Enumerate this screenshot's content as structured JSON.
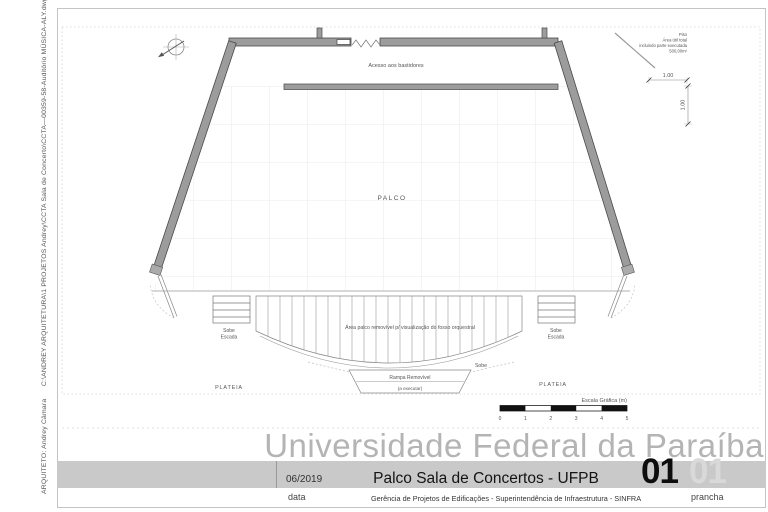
{
  "colors": {
    "wall_fill": "#9c9c9c",
    "wall_stroke": "#4a4a4a",
    "grid_line": "#e6e4e4",
    "band_bg": "#c9c9c9",
    "title_gray": "#b4b4b4",
    "sheet_number_black": "#0d0d0d",
    "sheet_number_ghost": "#d9d9d9"
  },
  "side_note": "ARQUITETO: Andrey Câmara      C:\\ANDREY ARQUITETURA\\1 PROJETOS Andrey\\CCTA Sala de Concerto\\CCTA—00359-58-Auditório MÚSICA-ALY.dwg",
  "plan": {
    "north_arrow_icon": "compass-north-icon",
    "access_label": "Acesso aos bastidores",
    "stage_label": "PALCO",
    "pit_label": "Área palco removível p/ visualização do fosso orquestral",
    "ramp_label": "Rampa Removível",
    "ramp_sublabel": "(a executar)",
    "sobe_label": "Sobe",
    "stair_left": {
      "line1": "Sobe",
      "line2": "Escada"
    },
    "stair_right": {
      "line1": "Sobe",
      "line2": "Escada"
    },
    "audience_left_label": "PLATEIA",
    "audience_right_label": "PLATEIA",
    "dim_width": "1.00",
    "dim_height": "1.00",
    "area_note": {
      "line1": "Piso",
      "line2": "Área útil total",
      "line3": "incluindo parte executada",
      "line4": "500,00m²"
    },
    "scale_bar": {
      "label": "Escala Gráfica (m)",
      "ticks": [
        "0",
        "1",
        "2",
        "3",
        "4",
        "5"
      ]
    }
  },
  "title_block": {
    "university": "Universidade Federal da Paraíba",
    "date": "06/2019",
    "date_caption": "data",
    "title": "Palco Sala de Concertos - UFPB",
    "subtitle": "Gerência de Projetos de Edificações - Superintendência de Infraestrutura -  SINFRA",
    "sheet_number": "01",
    "sheet_number_ghost": "01",
    "sheet_caption": "prancha"
  }
}
